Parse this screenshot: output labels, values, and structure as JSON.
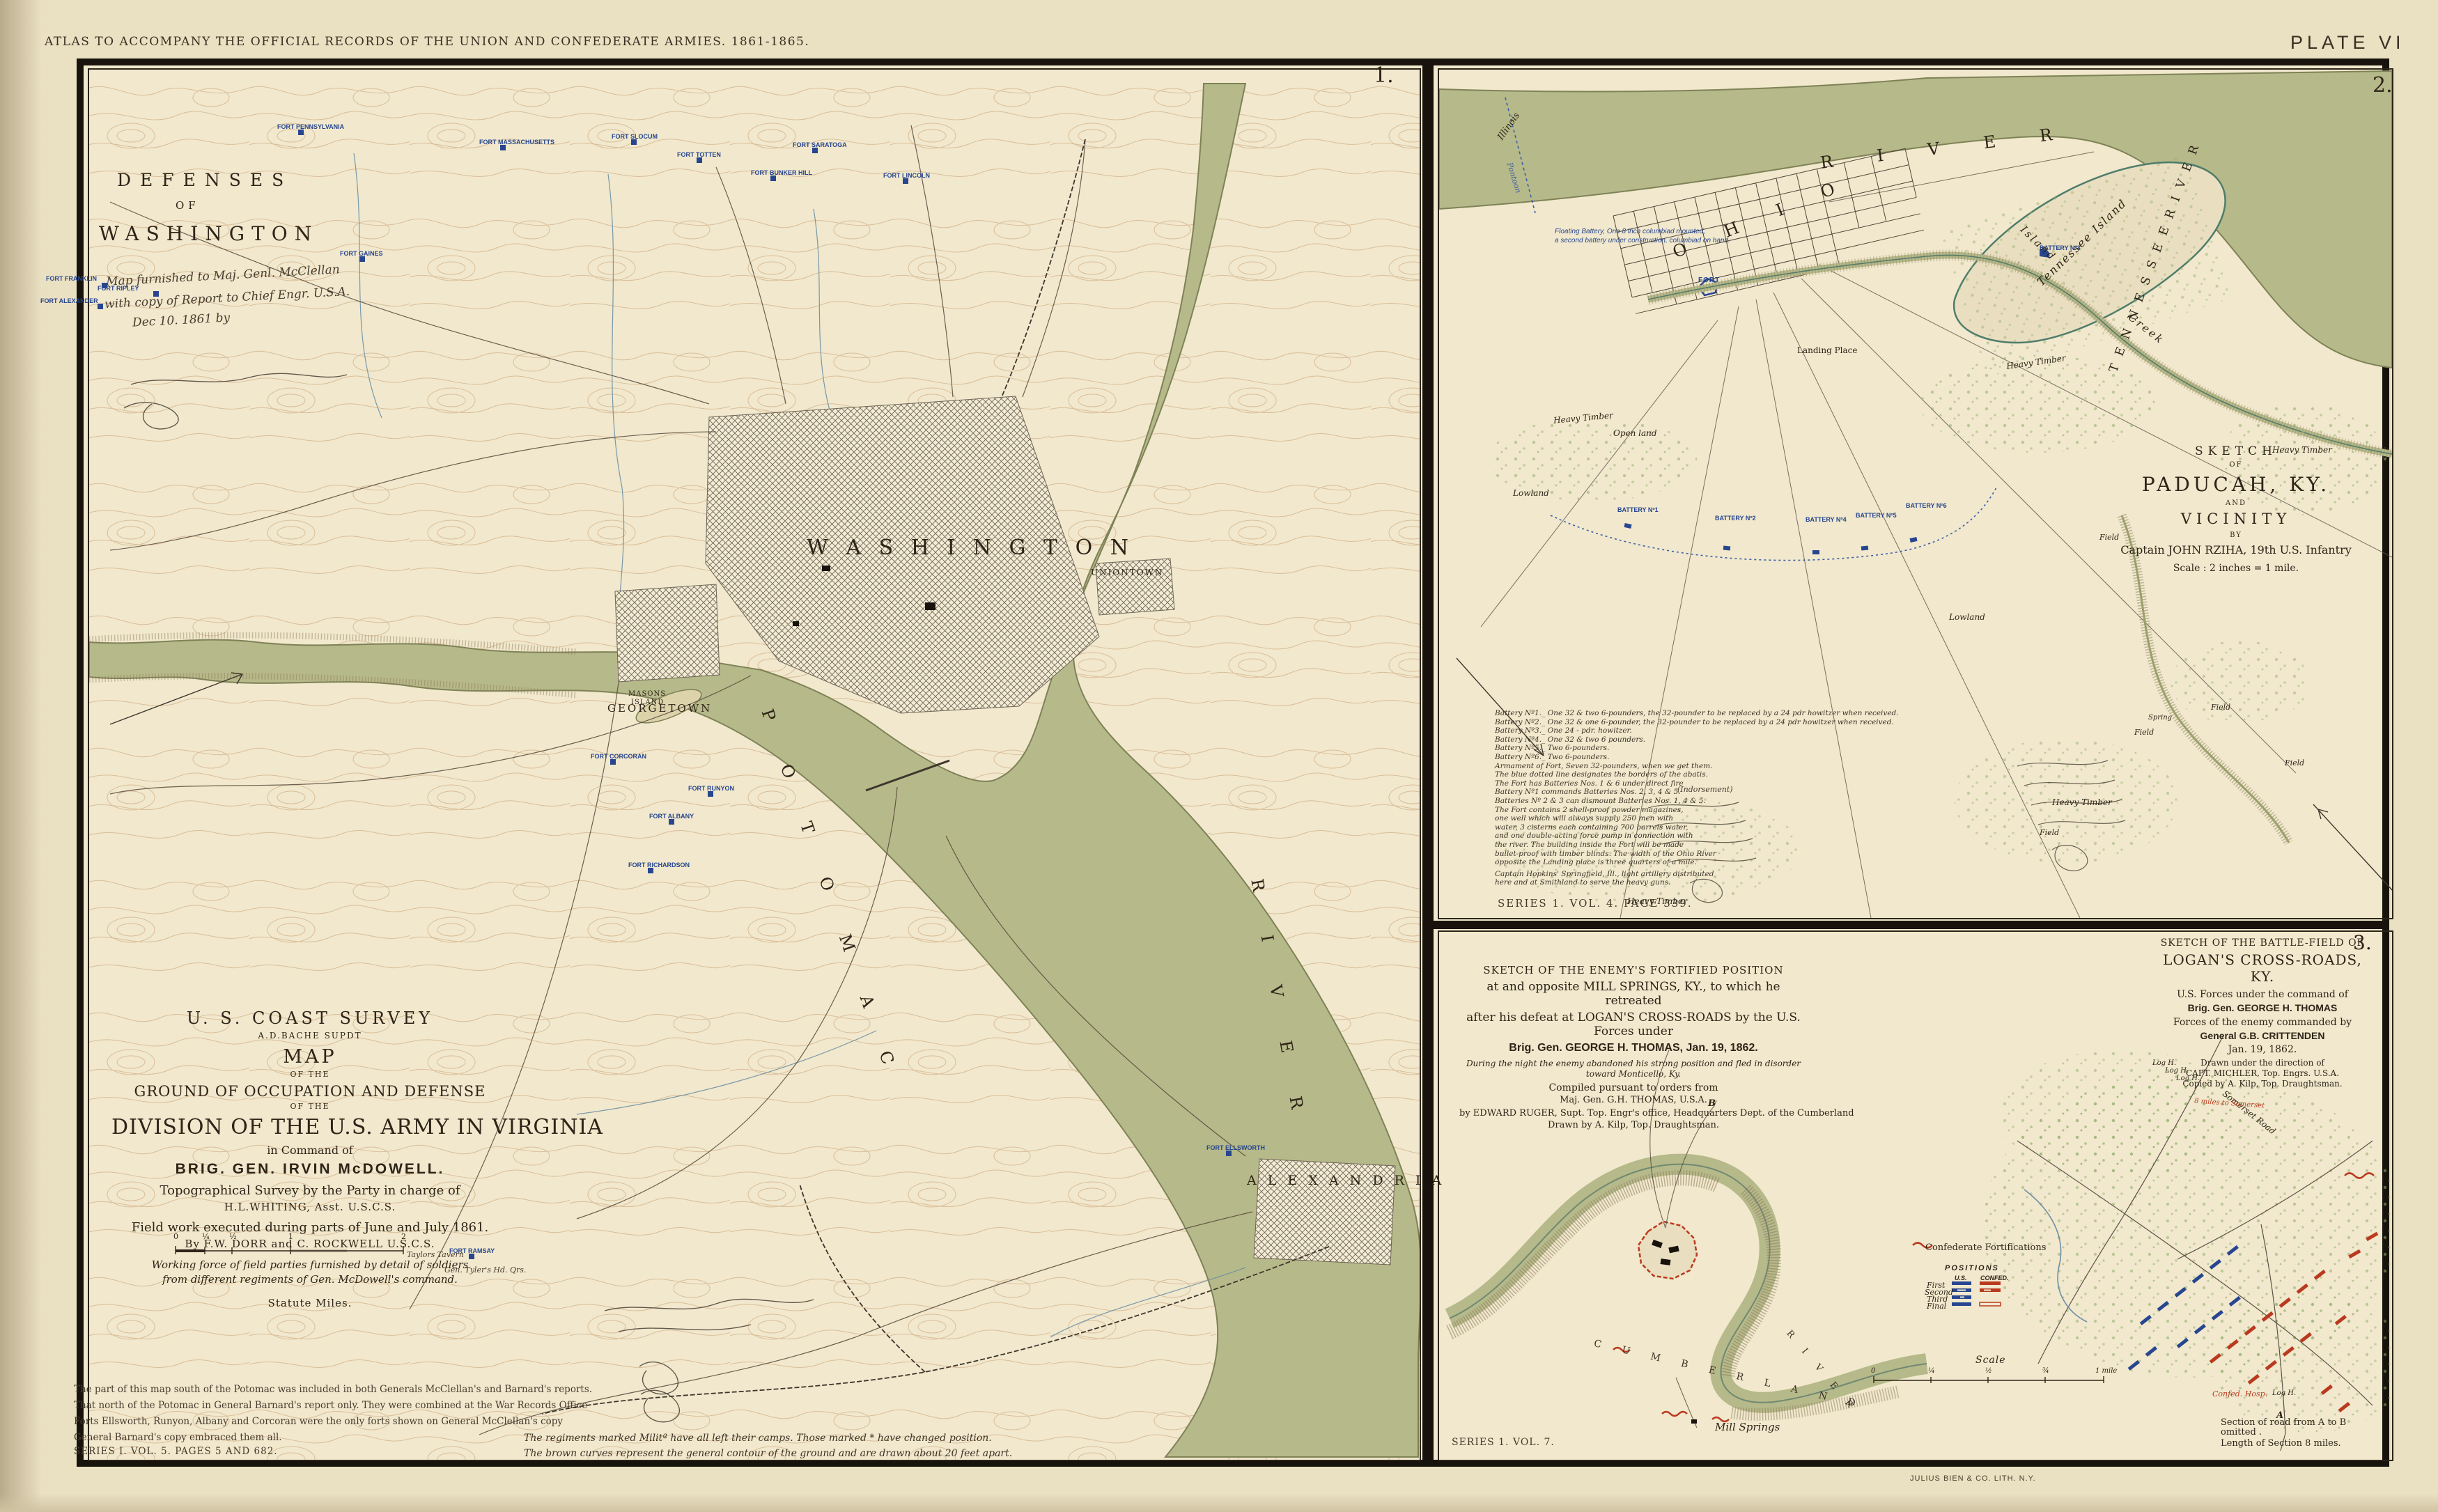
{
  "plate": {
    "header": "ATLAS TO ACCOMPANY THE OFFICIAL RECORDS OF THE UNION AND CONFEDERATE ARMIES. 1861-1865.",
    "plate_number": "PLATE VI",
    "printer": "JULIUS BIEN & CO. LITH. N.Y."
  },
  "colors": {
    "paper": "#f1e8cd",
    "water": "#b6b989",
    "contour": "#c79a6d",
    "union_blue": "#27468f",
    "confed_red": "#b93a1f",
    "ink": "#2e2418"
  },
  "map1": {
    "number": "1.",
    "title": {
      "l1": "DEFENSES",
      "l2": "OF",
      "l3": "WASHINGTON"
    },
    "handwriting": {
      "l1": "Map furnished to Maj. Genl. McClellan",
      "l2": "with copy of Report to Chief Engr. U.S.A.",
      "l3": "Dec 10. 1861  by"
    },
    "places": {
      "washington": "W A S H I N G T O N",
      "georgetown": "GEORGETOWN",
      "uniontown": "UNIONTOWN",
      "alexandria": "A L E X A N D R I A",
      "masons_1": "MASONS",
      "masons_2": "ISLAND",
      "potomac": "P O T O M A C",
      "river": "R I V E R",
      "taylors_tavern": "Taylors Tavern",
      "tylers_hq": "Gen. Tyler's Hd. Qrs."
    },
    "forts": [
      {
        "name": "FORT PENNSYLVANIA"
      },
      {
        "name": "FORT MASSACHUSETTS"
      },
      {
        "name": "FORT SLOCUM"
      },
      {
        "name": "FORT TOTTEN"
      },
      {
        "name": "FORT BUNKER HILL"
      },
      {
        "name": "FORT SARATOGA"
      },
      {
        "name": "FORT LINCOLN"
      },
      {
        "name": "FORT GAINES"
      },
      {
        "name": "FORT CORCORAN"
      },
      {
        "name": "FORT RUNYON"
      },
      {
        "name": "FORT ALBANY"
      },
      {
        "name": "FORT RICHARDSON"
      },
      {
        "name": "FORT ELLSWORTH"
      },
      {
        "name": "FORT RAMSAY"
      },
      {
        "name": "FORT FRANKLIN"
      },
      {
        "name": "FORT RIPLEY"
      },
      {
        "name": "FORT ALEXANDER"
      }
    ],
    "title_block": {
      "l1": "U. S. COAST SURVEY",
      "l2": "A.D.BACHE SUPDT",
      "l3": "MAP",
      "l4": "OF THE",
      "l5": "GROUND OF OCCUPATION AND DEFENSE",
      "l6": "OF THE",
      "l7": "DIVISION OF THE U.S. ARMY IN VIRGINIA",
      "l8": "in Command of",
      "l9": "BRIG. GEN. IRVIN McDOWELL.",
      "l10": "Topographical Survey by the Party in charge of",
      "l11": "H.L.WHITING, Asst. U.S.C.S.",
      "l12": "Field work executed during parts of June and July 1861.",
      "l13": "By F.W. DORR and C. ROCKWELL  U.S.C.S.",
      "l14": "Working force of field parties furnished by detail of soldiers",
      "l15": "from different regiments of Gen. McDowell's command.",
      "scale_label": "Statute Miles.",
      "scale_ticks": [
        "0",
        "¼",
        "½",
        "1",
        "2"
      ]
    },
    "notes": [
      "The part of this map south of the Potomac was included in both Generals McClellan's and Barnard's reports.",
      "That north of the Potomac in General Barnard's report only.   They were combined at the War Records Office",
      "Forts Ellsworth, Runyon, Albany and Corcoran were the only forts shown on General McClellan's copy",
      "General Barnard's copy embraced them all."
    ],
    "series": "SERIES I. VOL. 5. PAGES 5 AND 682.",
    "regiments_note": [
      "The regiments marked  Militª  have all left their camps. Those marked * have changed position.",
      "The brown curves represent the general contour of the ground and are drawn about 20 feet apart."
    ]
  },
  "map2": {
    "number": "2.",
    "river_labels": {
      "ohio": "O H I O",
      "river": "R I V E R",
      "tennessee_island": "Tennessee Island",
      "tennessee_river": "T E N N E S S E E   R I V E R",
      "illinois": "Illinois",
      "pontoon": "Pontoon",
      "landing": "Landing Place",
      "island_word": "Island",
      "creek_word": "Creek"
    },
    "floating_battery": {
      "l1": "Floating Battery, One 8 inch columbiad mounted,",
      "l2": "a second battery under construction, columbiad on hand."
    },
    "fort_label": "FORT",
    "batteries": [
      "BATTERY Nº1",
      "BATTERY Nº2",
      "BATTERY Nº3",
      "BATTERY Nº4",
      "BATTERY Nº5",
      "BATTERY Nº6"
    ],
    "terrain": {
      "ht1": "Heavy Timber",
      "ht2": "Heavy Timber",
      "ht3": "Heavy Timber",
      "ht4": "Heavy Timber",
      "ht5": "Heavy Timber",
      "open_land": "Open land",
      "lowland1": "Lowland",
      "lowland2": "Lowland",
      "field1": "Field",
      "field2": "Field",
      "field3": "Field",
      "field4": "Field",
      "field5": "Field",
      "spring": "Spring"
    },
    "title_block": {
      "l1": "SKETCH",
      "l2": "OF",
      "l3": "PADUCAH, KY.",
      "l4": "AND",
      "l5": "VICINITY",
      "l6": "BY",
      "l7": "Captain JOHN RZIHA, 19th U.S. Infantry",
      "l8": "Scale : 2 inches = 1 mile."
    },
    "notes": [
      "Battery Nº1._ One 32 & two 6-pounders, the 32-pounder to be replaced by a 24 pdr howitzer when received.",
      "Battery Nº2._ One 32 & one 6-pounder,   the 32-pounder to be replaced by a 24 pdr howitzer when received.",
      "Battery Nº3._ One 24 - pdr. howitzer.",
      "Battery Nº4._ One 32 & two 6 pounders.",
      "Battery Nº5._ Two 6-pounders.",
      "Battery Nº6._ Two 6-pounders.",
      "Armament of Fort, Seven 32-pounders, when we get them.",
      "The blue dotted line designates the borders of the abatis.",
      "The Fort has Batteries Nos. 1 & 6 under direct fire",
      "Battery Nº1 commands Batteries Nos. 2, 3, 4 & 5.",
      "Batteries Nº 2 & 3 can dismount Batteries Nos. 1, 4 & 5.",
      "The Fort contains 2 shell-proof powder magazines,",
      "one well which will always supply 250 men with",
      "water, 3 cisterns each containing 700 barrels water,",
      "and one double-acting force pump in connection with",
      "the river.   The building inside the Fort will be made",
      "bullet-proof with timber blinds. The width of the Ohio River",
      "opposite the Landing place is three quarters of a mile.",
      "Captain Hopkins' Springfield, Ill., light artillery distributed",
      "here and at Smithland to serve the heavy guns."
    ],
    "indorsement": "(Indorsement)",
    "series": "SERIES 1. VOL. 4. PAGE 339."
  },
  "map3": {
    "mill_springs": {
      "title": {
        "l1": "SKETCH OF THE ENEMY'S FORTIFIED POSITION",
        "l2": "at and opposite MILL SPRINGS, KY., to which he retreated",
        "l3": "after his defeat at LOGAN'S CROSS-ROADS by the U.S. Forces under",
        "l4": "Brig. Gen. GEORGE H. THOMAS, Jan. 19, 1862.",
        "l5": "During the night the enemy abandoned his strong position and fled in disorder",
        "l6": "toward Monticello, Ky.",
        "l7": "Compiled pursuant to orders from",
        "l8": "Maj. Gen. G.H. THOMAS, U.S.A.",
        "l9": "by EDWARD RUGER, Supt. Top. Engr's office, Headquarters Dept. of the Cumberland",
        "l10": "Drawn by A. Kilp, Top. Draughtsman."
      },
      "cumberland": "C U M B E R L A N D",
      "river2": "R I V E R",
      "mill_label": "Mill Springs",
      "b_marker": "B"
    },
    "logans": {
      "number": "3.",
      "title": {
        "l1": "SKETCH OF THE BATTLE-FIELD OF",
        "l2": "LOGAN'S CROSS-ROADS, KY.",
        "l3": "U.S. Forces under the command of",
        "l4": "Brig. Gen. GEORGE H. THOMAS",
        "l5": "Forces of the enemy commanded by",
        "l6": "General G.B. CRITTENDEN",
        "l7": "Jan. 19, 1862.",
        "l8": "Drawn under the direction of",
        "l9": "CAPT. MICHLER, Top. Engrs. U.S.A.",
        "l10": "Copied by A. Kilp, Top. Draughtsman."
      },
      "labels": {
        "somerset_road": "Somerset Road",
        "miles_to_somerset": "8 miles to Somerset",
        "log_h1": "Log H.",
        "log_h2": "Log H.",
        "log_h3": "Log H.",
        "log_h4": "Log H.",
        "confed_hosp": "Confed. Hosp.",
        "a_marker": "A"
      },
      "legend": {
        "fortifications": "Confederate Fortifications",
        "positions_title": "POSITIONS",
        "col_us": "U.S.",
        "col_confed": "CONFED.",
        "rows": [
          "First",
          "Second",
          "Third",
          "Final"
        ]
      },
      "scale_label": "Scale",
      "scale_ticks": [
        "0",
        "¼",
        "½",
        "¾",
        "1 mile"
      ],
      "section_note": [
        "Section of road from A to B",
        "omitted .",
        "Length of Section  8 miles."
      ],
      "series": "SERIES 1. VOL. 7."
    }
  }
}
